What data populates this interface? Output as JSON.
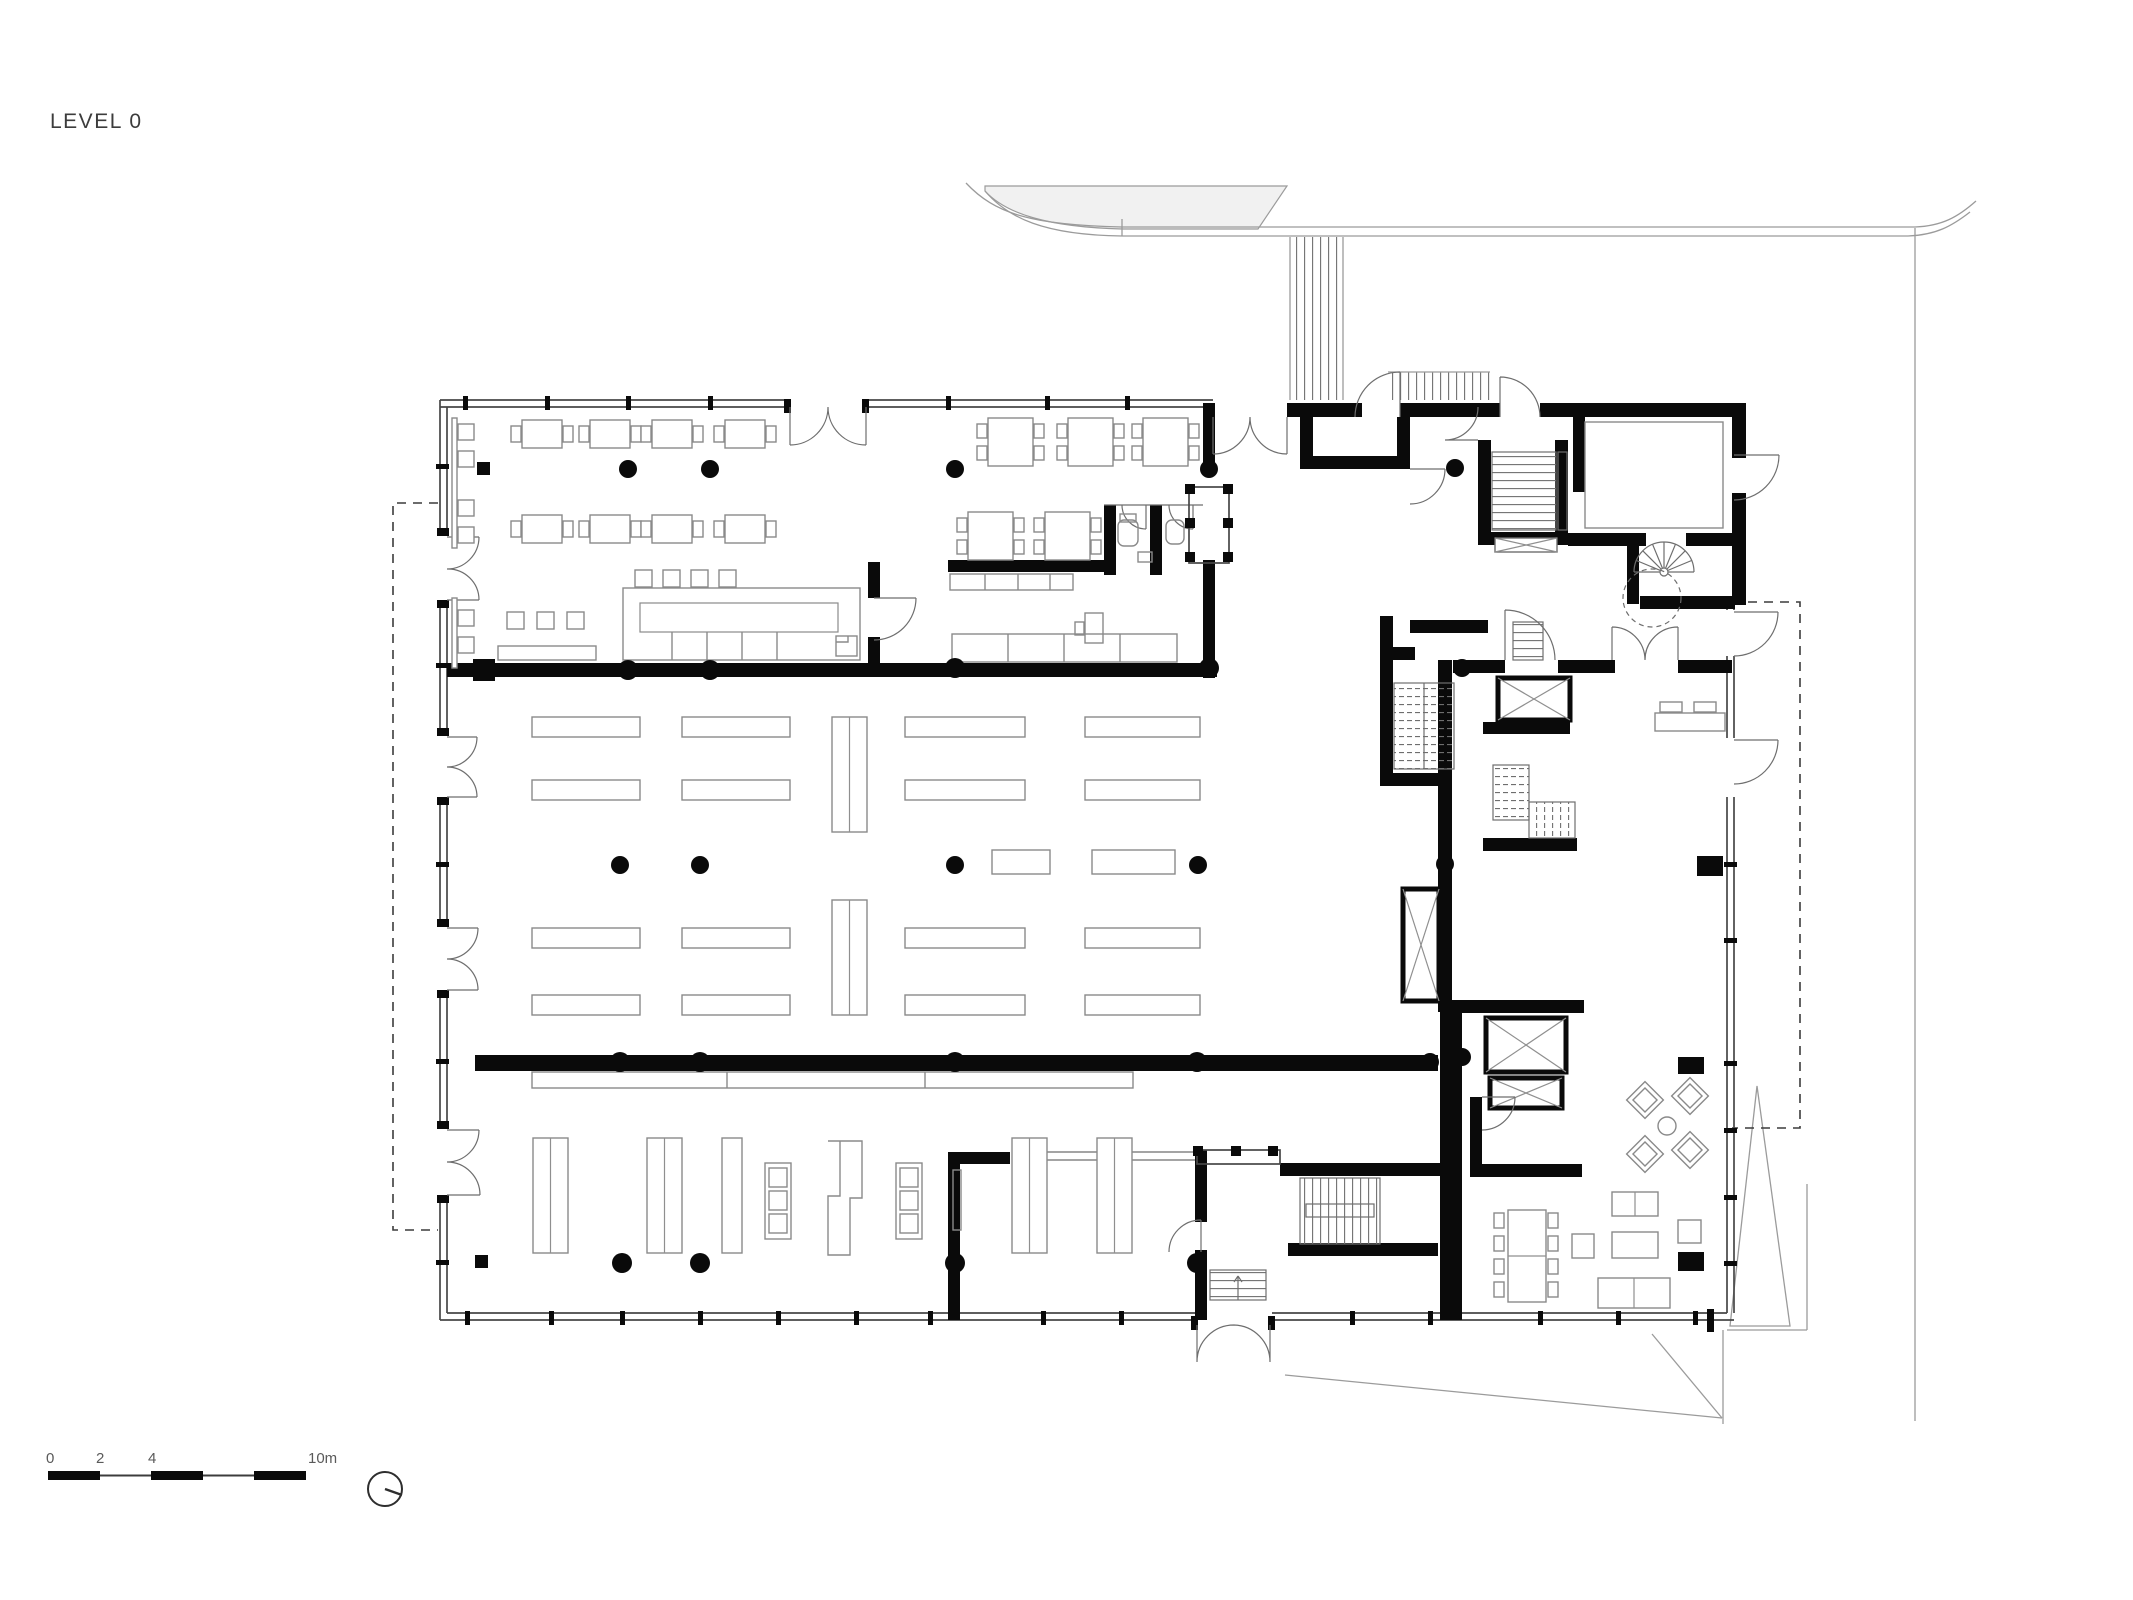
{
  "title": "LEVEL 0",
  "scale_bar": {
    "labels": [
      "0",
      "2",
      "4",
      "10m"
    ],
    "meters_total": 10,
    "segment_meters": 2
  },
  "north_indicator": {
    "icon": "north-arrow-icon"
  },
  "colors": {
    "wall": "#0a0a0a",
    "thin_line": "#474747",
    "furniture_line": "#8a8a8a",
    "site_line": "#9b9b9b",
    "site_fill": "#f1f1f1",
    "background": "#ffffff"
  }
}
